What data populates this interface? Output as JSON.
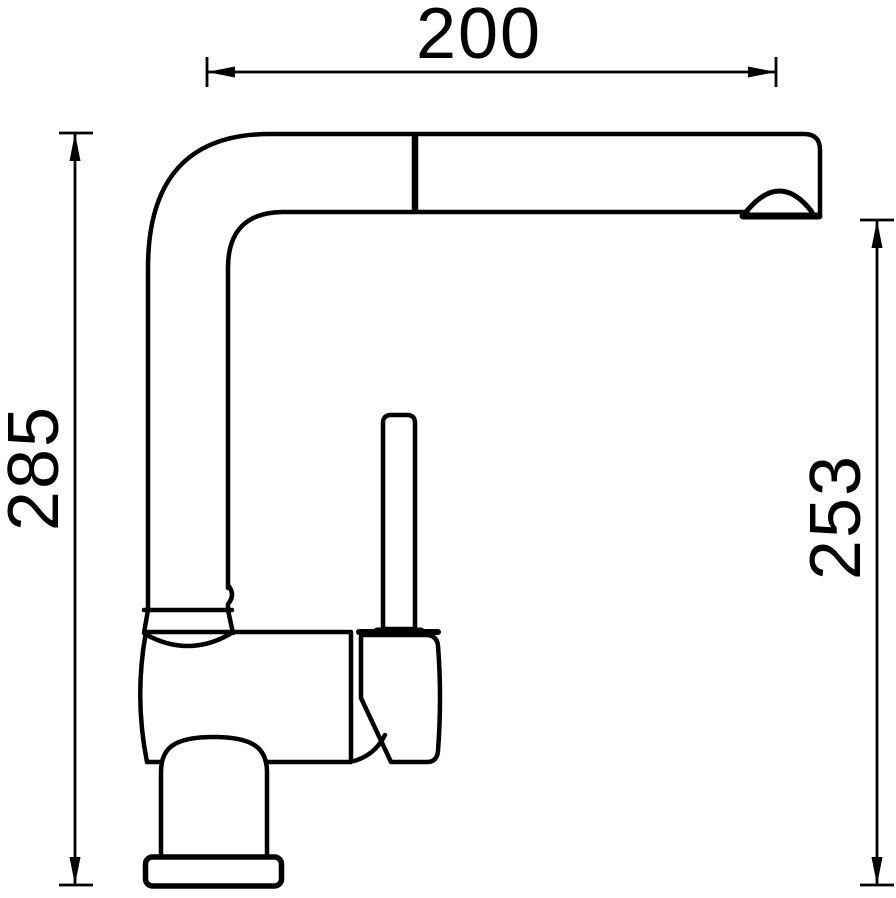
{
  "drawing": {
    "kind": "technical-dimension-drawing",
    "subject": "kitchen-mixer-tap-side-view",
    "background_color": "#ffffff",
    "line_color": "#000000",
    "dimensions": {
      "spout_reach": {
        "value": "200",
        "orientation": "horizontal",
        "position": "top"
      },
      "total_height": {
        "value": "285",
        "orientation": "vertical",
        "position": "left"
      },
      "spout_height": {
        "value": "253",
        "orientation": "vertical",
        "position": "right"
      }
    }
  }
}
